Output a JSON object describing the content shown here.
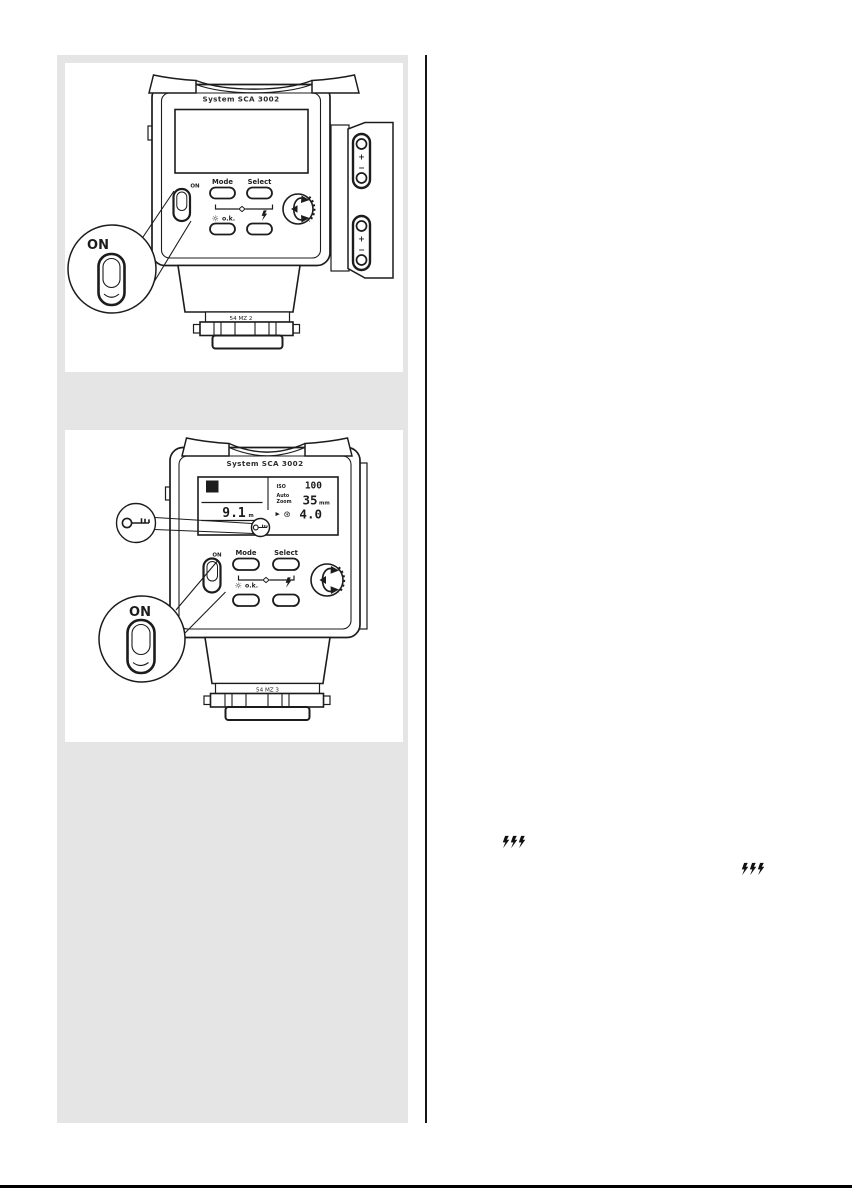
{
  "page": {
    "background": "#ffffff",
    "figure_panel_bg": "#e5e5e5",
    "ink": "#1c1c1c"
  },
  "figure1": {
    "title": "System SCA 3002",
    "buttons": {
      "mode": "Mode",
      "select": "Select",
      "ok": "o.k."
    },
    "on_switch_label": "ON",
    "on_callout_label": "ON",
    "model_label": "54 MZ 2",
    "side_panel": {
      "plus": "+",
      "minus": "−"
    }
  },
  "figure2": {
    "title": "System SCA 3002",
    "buttons": {
      "mode": "Mode",
      "select": "Select",
      "ok": "o.k."
    },
    "on_switch_label": "ON",
    "on_callout_label": "ON",
    "model_label": "54 MZ 3",
    "display": {
      "mode_badge": "A",
      "distance_value": "9.1",
      "distance_unit": "m",
      "iso_label": "ISO",
      "iso_value": "100",
      "auto_label": "Auto",
      "zoom_label": "Zoom",
      "zoom_value": "35",
      "zoom_unit": "mm",
      "pointer_glyph": "▶",
      "aperture_glyph": "⊛",
      "aperture_value": "4.0"
    }
  },
  "icons": {
    "sun_glyph": "☼",
    "flash_bolt": "lightning-bolt-arrow",
    "key": "key-lock-symbol"
  }
}
